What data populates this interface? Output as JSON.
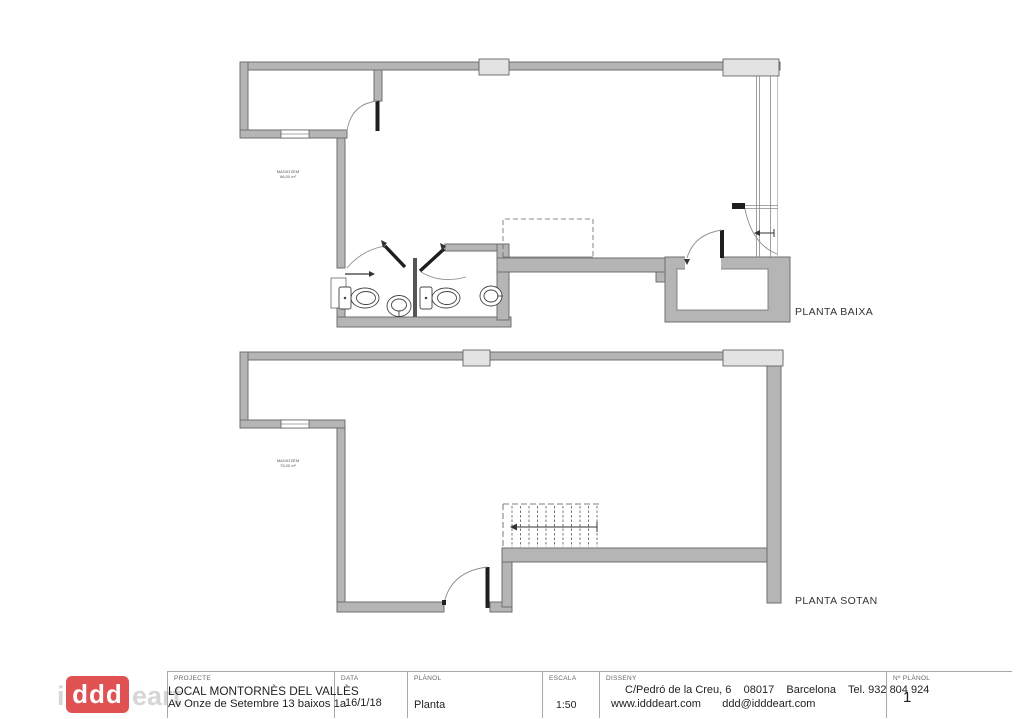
{
  "plans": {
    "planta_baixa": {
      "label": "PLANTA BAIXA",
      "annotation_line1": "MAGATZEM",
      "annotation_line2": "86,00 m²"
    },
    "planta_sotan": {
      "label": "PLANTA SOTAN",
      "annotation_line1": "MAGATZEM",
      "annotation_line2": "75,00 m²"
    }
  },
  "title_block": {
    "logo": {
      "prefix": "i",
      "box": "ddd",
      "suffix": "eart",
      "box_color": "#e05151"
    },
    "projecte": {
      "label": "PROJECTE",
      "line1": "LOCAL MONTORNÈS DEL VALLÈS",
      "line2": "Av Onze de Setembre 13 baixos 1a"
    },
    "data": {
      "label": "DATA",
      "value": "16/1/18"
    },
    "planol": {
      "label": "PLÀNOL",
      "value": "Planta"
    },
    "escala": {
      "label": "ESCALA",
      "value": "1:50"
    },
    "disseny": {
      "label": "DISSENY",
      "line1": "C/Pedró de la Creu, 6    08017    Barcelona    Tel. 932 804 924",
      "line2": "www.idddeart.com       ddd@idddeart.com"
    },
    "num_planol": {
      "label": "Nº PLÀNOL",
      "value": "1"
    }
  },
  "colors": {
    "wall_fill": "#b5b5b5",
    "wall_stroke": "#6f6f6f",
    "pillar_fill": "#e3e3e3",
    "door_leaf": "#1e1e1e",
    "arc_gray": "#8f8f8f",
    "logo_red": "#e05151"
  }
}
